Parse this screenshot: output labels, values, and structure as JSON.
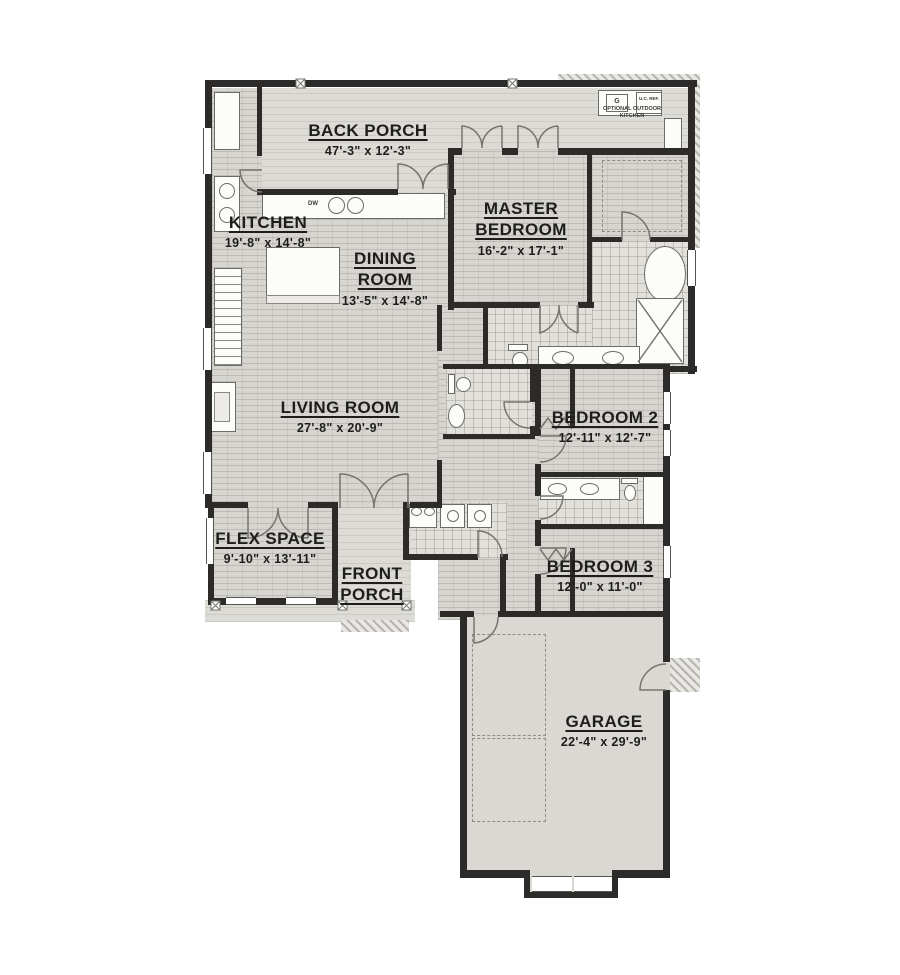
{
  "plan_title": "house floor plan",
  "rooms": [
    {
      "name": "BACK PORCH",
      "dims": "47'-3\" x 12'-3\""
    },
    {
      "name": "KITCHEN",
      "dims": "19'-8\" x 14'-8\""
    },
    {
      "name": "DINING",
      "name2": "ROOM",
      "dims": "13'-5\" x 14'-8\""
    },
    {
      "name": "MASTER",
      "name2": "BEDROOM",
      "dims": "16'-2\" x 17'-1\""
    },
    {
      "name": "LIVING ROOM",
      "dims": "27'-8\" x 20'-9\""
    },
    {
      "name": "BEDROOM 2",
      "dims": "12'-11\" x 12'-7\""
    },
    {
      "name": "FLEX SPACE",
      "dims": "9'-10\" x 13'-11\""
    },
    {
      "name": "FRONT",
      "name2": "PORCH"
    },
    {
      "name": "BEDROOM 3",
      "dims": "12'-0\" x 11'-0\""
    },
    {
      "name": "GARAGE",
      "dims": "22'-4\" x 29'-9\""
    }
  ],
  "annotations": {
    "outdoor_kitchen_line1": "OPTIONAL OUTDOOR",
    "outdoor_kitchen_line2": "KITCHEN",
    "uc_ref": "U.C. REF.",
    "grill": "G",
    "dishwasher": "DW"
  },
  "colors": {
    "wall": "#2c2b29",
    "floor_brick": "#d6d5d0",
    "floor_porch": "#dcdbd6",
    "floor_tile": "#e1e0db",
    "background": "#ffffff"
  }
}
